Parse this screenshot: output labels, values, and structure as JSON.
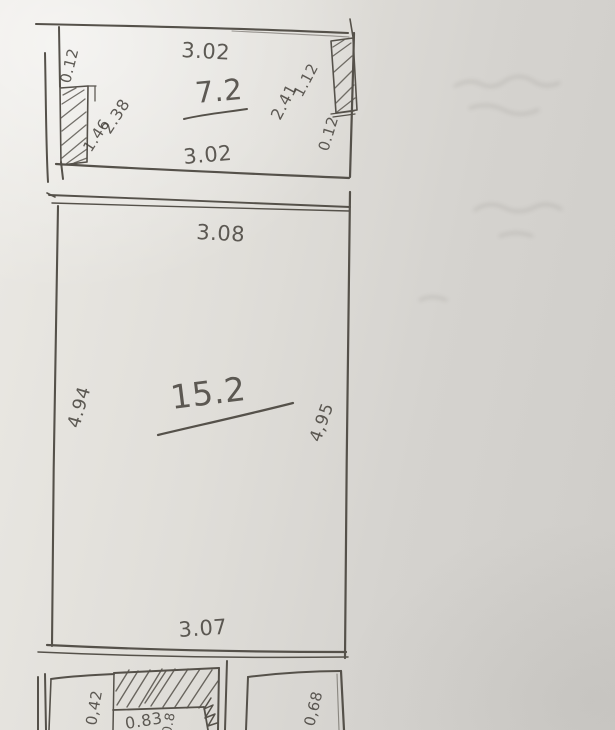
{
  "colors": {
    "paper": "#dcdad5",
    "pencil": "#55514a",
    "ink_text": "#45413b"
  },
  "upper_room": {
    "area": "7.2",
    "top_width": "3.02",
    "bottom_width": "3.02",
    "left_wall_thickness": "0.12",
    "left_window": "1.46",
    "left_height": "2.38",
    "right_height": "2.41",
    "right_window": "1.12",
    "right_wall_thickness": "0.12"
  },
  "main_room": {
    "area": "15.2",
    "top_width": "3.08",
    "bottom_width": "3.07",
    "left_height": "4.94",
    "right_height": "4,95"
  },
  "lower_room": {
    "left_dim": "0,42",
    "niche_width": "0.83",
    "partial_dim": "0.8",
    "right_dim": "0,68"
  }
}
